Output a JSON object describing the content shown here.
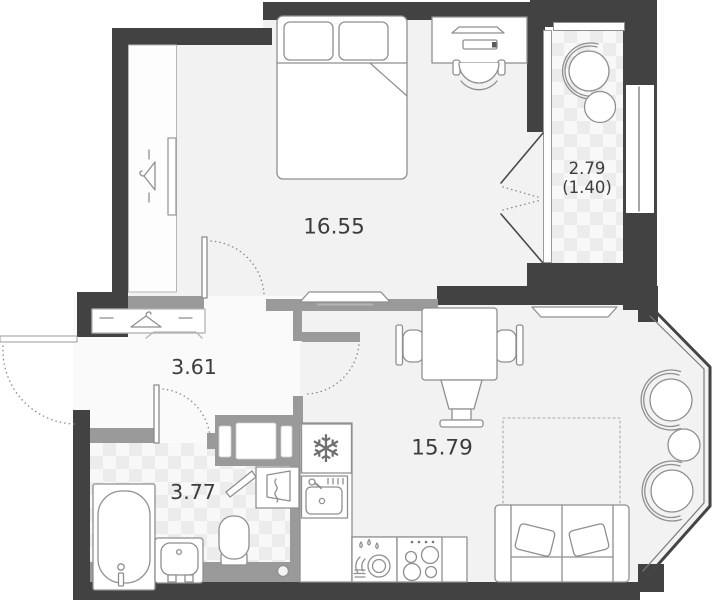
{
  "floor_plan": {
    "rooms": [
      {
        "name": "bedroom",
        "area": "16.55"
      },
      {
        "name": "loggia",
        "area": "2.79",
        "area_reduced": "(1.40)"
      },
      {
        "name": "hallway",
        "area": "3.61"
      },
      {
        "name": "bathroom",
        "area": "3.77"
      },
      {
        "name": "kitchen-living-room",
        "area": "15.79"
      }
    ],
    "colors": {
      "exterior_wall": "#424242",
      "partition_wall": "#9a9a9a",
      "floor": "#f2f2f2",
      "tile_accent": "#ececec",
      "furniture_outline": "#8f8f8f",
      "label_text": "#3c3c3c"
    }
  }
}
